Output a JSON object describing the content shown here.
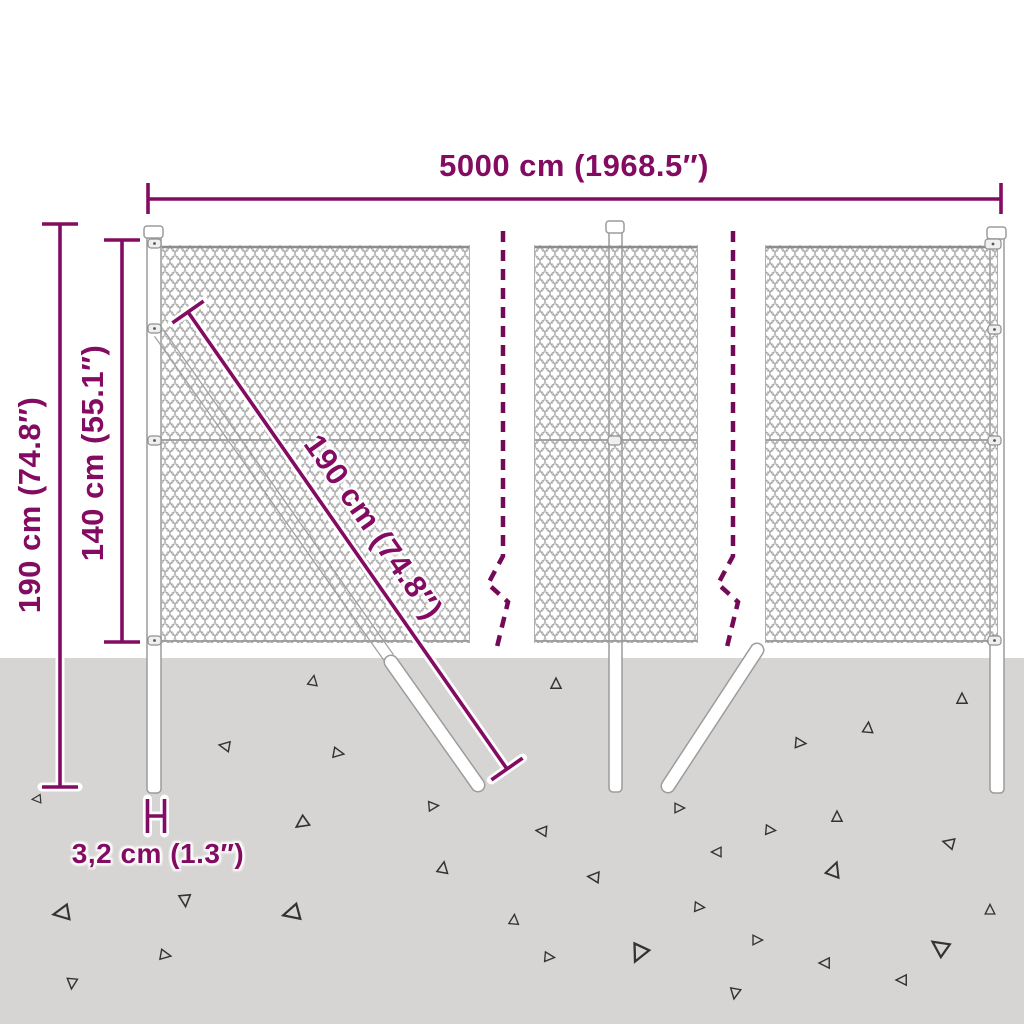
{
  "diagram": {
    "title": "Chain-link fence dimension diagram",
    "dimensions": {
      "width": {
        "label": "5000 cm (1968.5″)"
      },
      "total_height": {
        "label": "190 cm (74.8″)"
      },
      "mesh_height": {
        "label": "140 cm (55.1″)"
      },
      "post_length": {
        "label": "190 cm (74.8″)"
      },
      "post_diameter": {
        "label": "3,2 cm (1.3″)"
      }
    },
    "colors": {
      "dimension_accent": "#830c62",
      "dashed_break": "#730a58",
      "ground": "#d6d5d3",
      "mesh_wire": "#a6a6a6",
      "structure_outline": "#9c9c9c"
    }
  }
}
